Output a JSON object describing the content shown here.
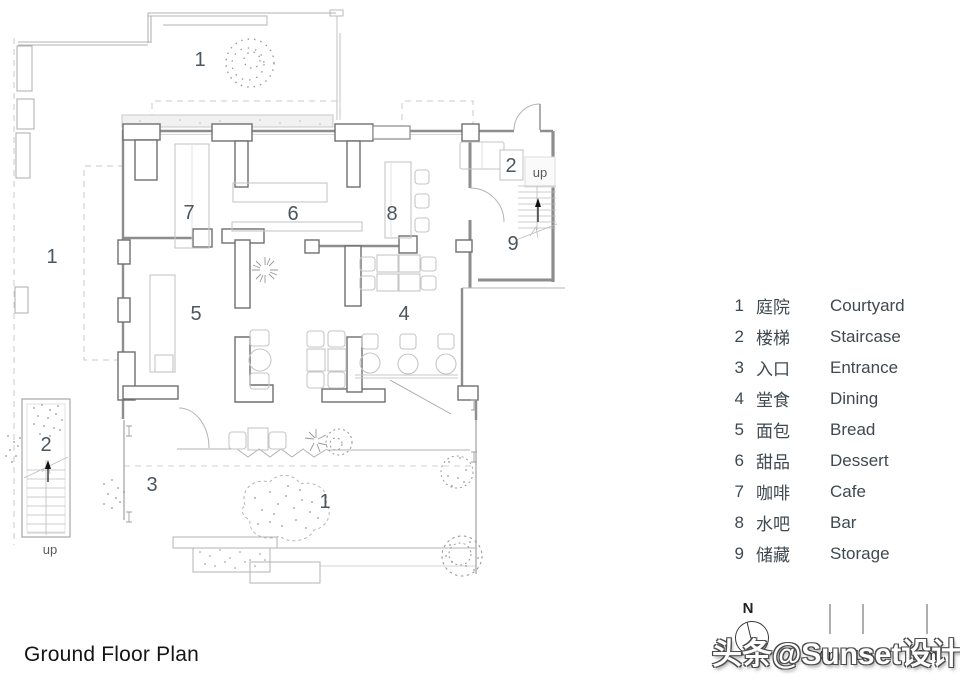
{
  "page": {
    "title": "Ground Floor Plan"
  },
  "watermark": {
    "text": "头条@Sunset设计"
  },
  "north_arrow": {
    "label": "N"
  },
  "scale_bar": {
    "marks": [
      "0m",
      "1m",
      "3m"
    ]
  },
  "plan": {
    "room_labels": [
      {
        "text": "1"
      },
      {
        "text": "1"
      },
      {
        "text": "1"
      },
      {
        "text": "7"
      },
      {
        "text": "6"
      },
      {
        "text": "8"
      },
      {
        "text": "2"
      },
      {
        "text": "up"
      },
      {
        "text": "9"
      },
      {
        "text": "5"
      },
      {
        "text": "4"
      },
      {
        "text": "3"
      },
      {
        "text": "2"
      },
      {
        "text": "up"
      }
    ]
  },
  "legend": {
    "items": [
      {
        "num": "1",
        "zh": "庭院",
        "en": "Courtyard"
      },
      {
        "num": "2",
        "zh": "楼梯",
        "en": "Staircase"
      },
      {
        "num": "3",
        "zh": "入口",
        "en": "Entrance"
      },
      {
        "num": "4",
        "zh": "堂食",
        "en": "Dining"
      },
      {
        "num": "5",
        "zh": "面包",
        "en": "Bread"
      },
      {
        "num": "6",
        "zh": "甜品",
        "en": "Dessert"
      },
      {
        "num": "7",
        "zh": "咖啡",
        "en": "Cafe"
      },
      {
        "num": "8",
        "zh": "水吧",
        "en": "Bar"
      },
      {
        "num": "9",
        "zh": "储藏",
        "en": "Storage"
      }
    ]
  }
}
